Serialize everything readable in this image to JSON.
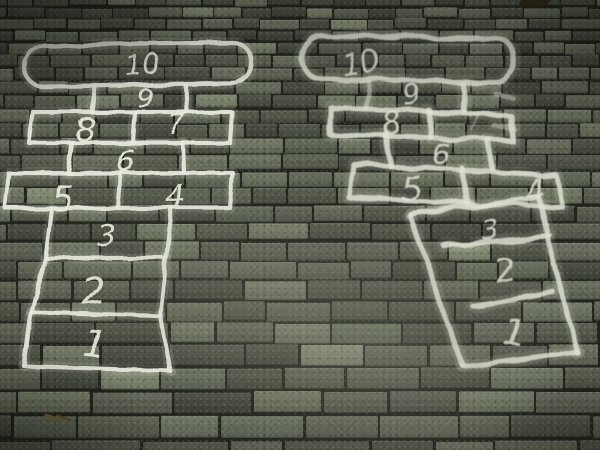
{
  "scene": {
    "description": "Two hopscotch courts drawn in white chalk paint on dark grey-green brick pavement, seen from above at an angle",
    "chalk_color": "#e9ebdf",
    "chalk_color_faded": "#dfe3d4",
    "pavement_brick_color": "#4d5244",
    "pavement_joint_color": "#20241d",
    "debris": {
      "twig": {
        "name": "small brown twig",
        "color": "#6e5b37"
      },
      "leaf": {
        "name": "dark leaf at top edge",
        "color": "#2e2818"
      }
    }
  },
  "courts": [
    {
      "name": "left-hopscotch-court",
      "style": "crisp",
      "cells": [
        {
          "label": "10"
        },
        {
          "label": "9"
        },
        {
          "label": "8"
        },
        {
          "label": "7"
        },
        {
          "label": "6"
        },
        {
          "label": "5"
        },
        {
          "label": "4"
        },
        {
          "label": "3"
        },
        {
          "label": "2"
        },
        {
          "label": "1"
        }
      ]
    },
    {
      "name": "right-hopscotch-court",
      "style": "faded",
      "cells": [
        {
          "label": "10"
        },
        {
          "label": "9"
        },
        {
          "label": "8"
        },
        {
          "label": "7"
        },
        {
          "label": "6"
        },
        {
          "label": "5"
        },
        {
          "label": "4"
        },
        {
          "label": "3"
        },
        {
          "label": "2"
        },
        {
          "label": "1"
        }
      ]
    }
  ]
}
